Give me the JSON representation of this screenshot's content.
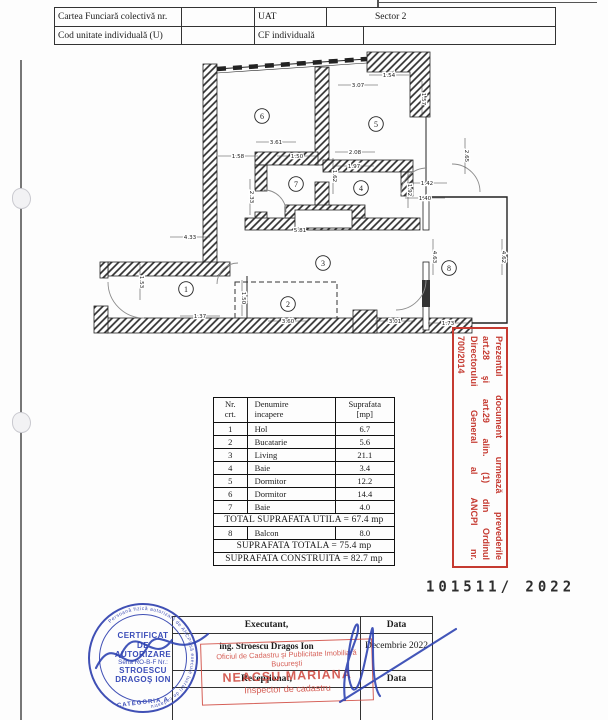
{
  "header_table": {
    "rows": [
      {
        "c1": "Cartea Funciară colectivă nr.",
        "c2": "",
        "c3": "UAT",
        "c4": "Sector 2"
      },
      {
        "c1": "Cod unitate individuală (U)",
        "c2": "",
        "c3": "CF individuală",
        "c4": ""
      }
    ]
  },
  "plan": {
    "rooms": [
      {
        "n": "6",
        "x": 172,
        "y": 74
      },
      {
        "n": "5",
        "x": 286,
        "y": 82
      },
      {
        "n": "7",
        "x": 206,
        "y": 142
      },
      {
        "n": "4",
        "x": 271,
        "y": 146
      },
      {
        "n": "3",
        "x": 233,
        "y": 221
      },
      {
        "n": "1",
        "x": 96,
        "y": 247
      },
      {
        "n": "2",
        "x": 198,
        "y": 262
      },
      {
        "n": "8",
        "x": 359,
        "y": 226
      }
    ],
    "dimensions": [
      {
        "t": "3.61",
        "x": 186,
        "y": 102,
        "r": 0
      },
      {
        "t": "3.07",
        "x": 268,
        "y": 45,
        "r": 0
      },
      {
        "t": "1.54",
        "x": 299,
        "y": 35,
        "r": 0
      },
      {
        "t": "1.57",
        "x": 332,
        "y": 57,
        "r": 90
      },
      {
        "t": "1.58",
        "x": 148,
        "y": 116,
        "r": 0
      },
      {
        "t": "1.50",
        "x": 207,
        "y": 116,
        "r": 0
      },
      {
        "t": "2.08",
        "x": 265,
        "y": 112,
        "r": 0
      },
      {
        "t": "1.97",
        "x": 264,
        "y": 126,
        "r": 0
      },
      {
        "t": "2.33",
        "x": 160,
        "y": 155,
        "r": 90
      },
      {
        "t": "1.62",
        "x": 243,
        "y": 134,
        "r": 90
      },
      {
        "t": "1.42",
        "x": 337,
        "y": 143,
        "r": 0
      },
      {
        "t": "1.40",
        "x": 335,
        "y": 158,
        "r": 0
      },
      {
        "t": "1.92",
        "x": 318,
        "y": 148,
        "r": 90
      },
      {
        "t": "2.65",
        "x": 375,
        "y": 114,
        "r": 90
      },
      {
        "t": "5.81",
        "x": 210,
        "y": 190,
        "r": 0
      },
      {
        "t": "4.33",
        "x": 100,
        "y": 197,
        "r": 0
      },
      {
        "t": "1.53",
        "x": 50,
        "y": 240,
        "r": 90
      },
      {
        "t": "1.37",
        "x": 110,
        "y": 276,
        "r": 0
      },
      {
        "t": "1.50",
        "x": 152,
        "y": 256,
        "r": 90
      },
      {
        "t": "3.60",
        "x": 198,
        "y": 281,
        "r": 0
      },
      {
        "t": "3.01",
        "x": 305,
        "y": 281,
        "r": 0
      },
      {
        "t": "1.73",
        "x": 358,
        "y": 283,
        "r": 0
      },
      {
        "t": "4.63",
        "x": 343,
        "y": 215,
        "r": 90
      },
      {
        "t": "4.62",
        "x": 412,
        "y": 215,
        "r": 90
      }
    ]
  },
  "areas_table": {
    "headers": [
      "Nr.\ncrt.",
      "Denumire\nincapere",
      "Suprafata\n[mp]"
    ],
    "rows": [
      [
        "1",
        "Hol",
        "6.7"
      ],
      [
        "2",
        "Bucatarie",
        "5.6"
      ],
      [
        "3",
        "Living",
        "21.1"
      ],
      [
        "4",
        "Baie",
        "3.4"
      ],
      [
        "5",
        "Dormitor",
        "12.2"
      ],
      [
        "6",
        "Dormitor",
        "14.4"
      ],
      [
        "7",
        "Baie",
        "4.0"
      ]
    ],
    "total_utila": "TOTAL SUPRAFATA UTILA = 67.4 mp",
    "balcon_row": [
      "8",
      "Balcon",
      "8.0"
    ],
    "total_totala": "SUPRAFATA TOTALA = 75.4 mp",
    "total_construita": "SUPRAFATA CONSTRUITA = 82.7 mp"
  },
  "red_side_stamp": {
    "color": "#c53a31",
    "lines": [
      "Prezentul document urmează prevederile",
      "art.28 şi art.29 alin. (1) din Ordinul",
      "Directorului General al ANCPI nr.",
      "700/2014"
    ]
  },
  "doc_number": "101511/ 2022",
  "bottom_table": {
    "executant_label": "Executant,",
    "data_label": "Data",
    "executant_value": "ing. Stroescu Dragos Ion",
    "data_value": "Decembrie 2022",
    "receptionat_label": "Recepţionat,",
    "data_label2": "Data"
  },
  "receipt_stamp": {
    "color": "#d0493f",
    "lines": [
      "Oficiul de Cadastru şi Publicitate Imobiliară",
      "Bucureşti",
      "NEACŞU MARIANA",
      "Inspector de cadastru"
    ]
  },
  "round_stamp": {
    "color": "#4050b5",
    "rim": "Persoană fizică autorizată de ANCPI să execute lucrări de cadastru",
    "l1": "CERTIFICAT",
    "l2": "DE",
    "l3": "AUTORIZARE",
    "l4": "Seria RO-B-F Nr.:",
    "l5": "STROESCU",
    "l6": "DRAGOŞ ION",
    "arc_bottom": "CATEGORIA A"
  }
}
